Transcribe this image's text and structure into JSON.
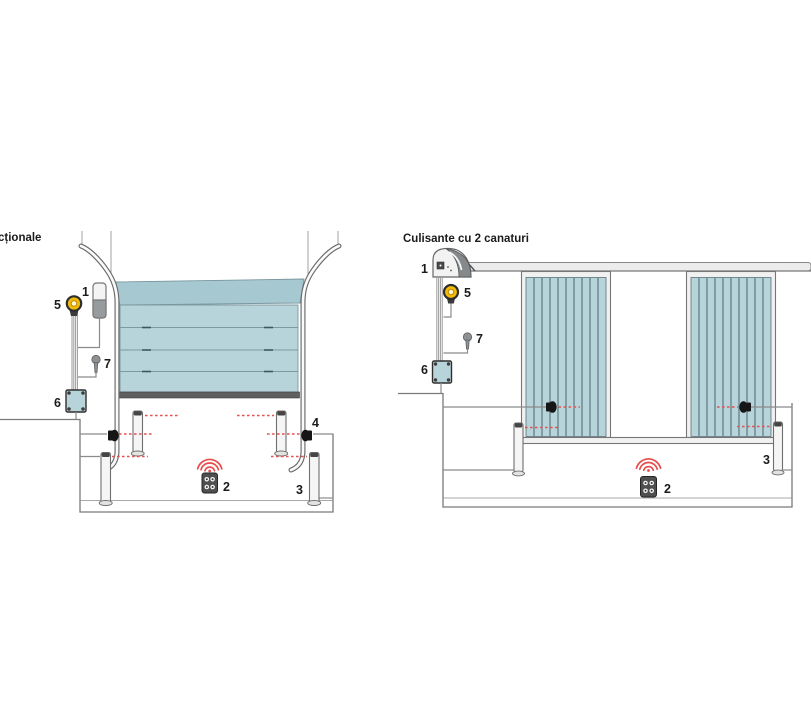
{
  "diagrams": {
    "left": {
      "title": "cționale",
      "callout_labels": {
        "motor": "1",
        "remote": "2",
        "outer_photocell_post": "3",
        "wall_photocell": "4",
        "flashing_lamp": "5",
        "control_box": "6",
        "key_selector": "7"
      }
    },
    "right": {
      "title": "Culisante cu 2 canaturi",
      "callout_labels": {
        "motor": "1",
        "remote": "2",
        "photocell_post": "3",
        "flashing_lamp": "5",
        "control_box": "6",
        "key_selector": "7"
      }
    }
  },
  "colors": {
    "background": "#ffffff",
    "door_fill": "#b7d4da",
    "door_fill_dark": "#a6c8d1",
    "beam_red": "#e25555",
    "signal_red": "#e84b4b",
    "lamp_yellow": "#f2ba0a",
    "structure_gray": "#777777",
    "text_dark": "#1b1b1b"
  }
}
